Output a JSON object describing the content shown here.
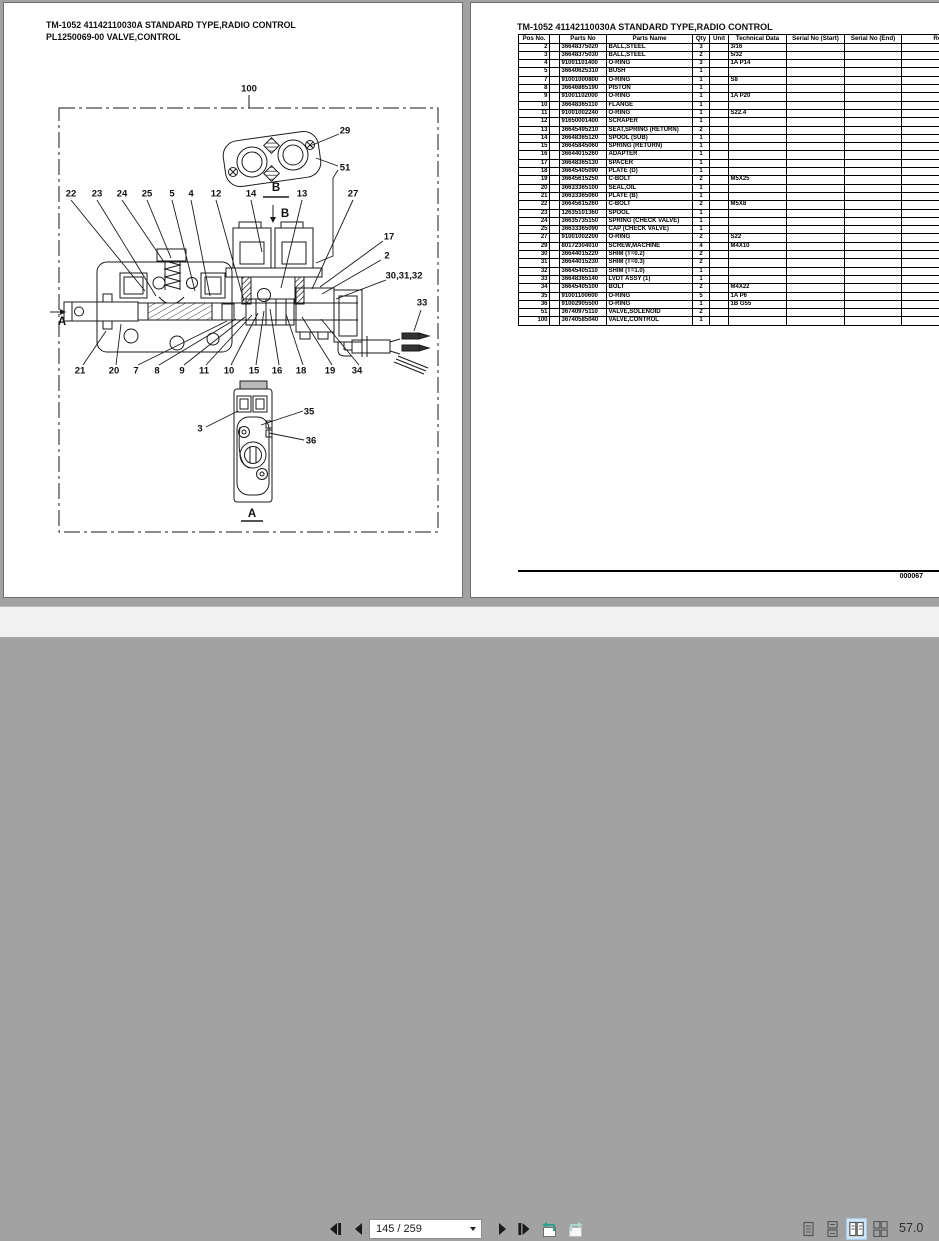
{
  "viewer": {
    "colors": {
      "canvas": "#a2a2a2",
      "toolbar_bg": "#f1f1f1",
      "active_view_bg": "#cfe3f6",
      "view_history_arrow": "#2fa08e"
    },
    "toolbar": {
      "page_indicator": "145 / 259",
      "zoom_level": "57.0",
      "active_view_mode": "facing-pages"
    }
  },
  "left_page": {
    "title_line1": "TM-1052 41142110030A STANDARD TYPE,RADIO CONTROL",
    "title_line2": "PL1250069-00 VALVE,CONTROL",
    "diagram": {
      "callouts": [
        {
          "label": "100",
          "x": 249,
          "y": 89
        },
        {
          "label": "29",
          "x": 345,
          "y": 131
        },
        {
          "label": "51",
          "x": 345,
          "y": 168
        },
        {
          "label": "B",
          "x": 276,
          "y": 188,
          "size": 11.5
        },
        {
          "label": "B",
          "x": 285,
          "y": 214,
          "size": 11.5
        },
        {
          "label": "22",
          "x": 71,
          "y": 194
        },
        {
          "label": "23",
          "x": 97,
          "y": 194
        },
        {
          "label": "24",
          "x": 122,
          "y": 194
        },
        {
          "label": "25",
          "x": 147,
          "y": 194
        },
        {
          "label": "5",
          "x": 172,
          "y": 194
        },
        {
          "label": "4",
          "x": 191,
          "y": 194
        },
        {
          "label": "12",
          "x": 216,
          "y": 194
        },
        {
          "label": "14",
          "x": 251,
          "y": 194
        },
        {
          "label": "13",
          "x": 302,
          "y": 194
        },
        {
          "label": "27",
          "x": 353,
          "y": 194
        },
        {
          "label": "17",
          "x": 389,
          "y": 237
        },
        {
          "label": "2",
          "x": 387,
          "y": 256
        },
        {
          "label": "30,31,32",
          "x": 404,
          "y": 276
        },
        {
          "label": "33",
          "x": 422,
          "y": 303
        },
        {
          "label": "A",
          "x": 62,
          "y": 322,
          "size": 11.5
        },
        {
          "label": "21",
          "x": 80,
          "y": 371
        },
        {
          "label": "20",
          "x": 114,
          "y": 371
        },
        {
          "label": "7",
          "x": 136,
          "y": 371
        },
        {
          "label": "8",
          "x": 157,
          "y": 371
        },
        {
          "label": "9",
          "x": 182,
          "y": 371
        },
        {
          "label": "11",
          "x": 204,
          "y": 371
        },
        {
          "label": "10",
          "x": 229,
          "y": 371
        },
        {
          "label": "15",
          "x": 254,
          "y": 371
        },
        {
          "label": "16",
          "x": 277,
          "y": 371
        },
        {
          "label": "18",
          "x": 301,
          "y": 371
        },
        {
          "label": "19",
          "x": 330,
          "y": 371
        },
        {
          "label": "34",
          "x": 357,
          "y": 371
        },
        {
          "label": "3",
          "x": 200,
          "y": 429
        },
        {
          "label": "35",
          "x": 309,
          "y": 412
        },
        {
          "label": "36",
          "x": 311,
          "y": 441
        },
        {
          "label": "A",
          "x": 252,
          "y": 514,
          "size": 11.5
        }
      ]
    }
  },
  "right_page": {
    "title": "TM-1052 41142110030A STANDARD TYPE,RADIO CONTROL",
    "page_number": "000067",
    "parts_table": {
      "headers": [
        "Pos No.",
        "",
        "Parts No",
        "Parts Name",
        "Qty",
        "Unit",
        "Technical Data",
        "Serial No (Start)",
        "Serial No (End)",
        "Remarks"
      ],
      "rows": [
        [
          "2",
          "36648375020",
          "BALL,STEEL",
          "3",
          "",
          "3/16",
          "",
          "",
          ""
        ],
        [
          "3",
          "36648375030",
          "BALL,STEEL",
          "2",
          "",
          "5/32",
          "",
          "",
          ""
        ],
        [
          "4",
          "91001101400",
          "O-RING",
          "3",
          "",
          "1A P14",
          "",
          "",
          ""
        ],
        [
          "5",
          "36640625310",
          "BUSH",
          "1",
          "",
          "",
          "",
          "",
          ""
        ],
        [
          "7",
          "91001000800",
          "O-RING",
          "1",
          "",
          "S8",
          "",
          "",
          ""
        ],
        [
          "8",
          "36646865190",
          "PISTON",
          "1",
          "",
          "",
          "",
          "",
          ""
        ],
        [
          "9",
          "91001102000",
          "O-RING",
          "1",
          "",
          "1A P20",
          "",
          "",
          ""
        ],
        [
          "10",
          "36648365110",
          "FLANGE",
          "1",
          "",
          "",
          "",
          "",
          ""
        ],
        [
          "11",
          "91001002240",
          "O-RING",
          "1",
          "",
          "S22.4",
          "",
          "",
          ""
        ],
        [
          "12",
          "91650001400",
          "SCRAPER",
          "1",
          "",
          "",
          "",
          "",
          ""
        ],
        [
          "13",
          "36645495210",
          "SEAT,SPRING (RETURN)",
          "2",
          "",
          "",
          "",
          "",
          ""
        ],
        [
          "14",
          "36648365120",
          "SPOOL (SUB)",
          "1",
          "",
          "",
          "",
          "",
          ""
        ],
        [
          "15",
          "36645845060",
          "SPRING (RETURN)",
          "1",
          "",
          "",
          "",
          "",
          ""
        ],
        [
          "16",
          "36644015260",
          "ADAPTER",
          "1",
          "",
          "",
          "",
          "",
          ""
        ],
        [
          "17",
          "36648365130",
          "SPACER",
          "1",
          "",
          "",
          "",
          "",
          ""
        ],
        [
          "18",
          "36645405090",
          "PLATE (D)",
          "1",
          "",
          "",
          "",
          "",
          ""
        ],
        [
          "19",
          "36645615250",
          "C-BOLT",
          "2",
          "",
          "M5X25",
          "",
          "",
          ""
        ],
        [
          "20",
          "36633365100",
          "SEAL,OIL",
          "1",
          "",
          "",
          "",
          "",
          ""
        ],
        [
          "21",
          "36633365060",
          "PLATE (B)",
          "1",
          "",
          "",
          "",
          "",
          ""
        ],
        [
          "22",
          "36645615260",
          "C-BOLT",
          "2",
          "",
          "M5X8",
          "",
          "",
          ""
        ],
        [
          "23",
          "12635101360",
          "SPOOL",
          "1",
          "",
          "",
          "",
          "",
          ""
        ],
        [
          "24",
          "36635735150",
          "SPRING (CHECK VALVE)",
          "1",
          "",
          "",
          "",
          "",
          ""
        ],
        [
          "25",
          "36633365090",
          "CAP (CHECK VALVE)",
          "1",
          "",
          "",
          "",
          "",
          ""
        ],
        [
          "27",
          "91001002200",
          "O-RING",
          "2",
          "",
          "S22",
          "",
          "",
          ""
        ],
        [
          "29",
          "80172304010",
          "SCREW,MACHINE",
          "4",
          "",
          "M4X10",
          "",
          "",
          ""
        ],
        [
          "30",
          "36644015220",
          "SHIM (T=0.2)",
          "2",
          "",
          "",
          "",
          "",
          ""
        ],
        [
          "31",
          "36644015230",
          "SHIM (T=0.3)",
          "2",
          "",
          "",
          "",
          "",
          ""
        ],
        [
          "32",
          "36645405110",
          "SHIM (T=1.0)",
          "1",
          "",
          "",
          "",
          "",
          ""
        ],
        [
          "33",
          "36648365140",
          "LVDT ASSY (1)",
          "1",
          "",
          "",
          "",
          "",
          ""
        ],
        [
          "34",
          "36645405100",
          "BOLT",
          "2",
          "",
          "M4X22",
          "",
          "",
          ""
        ],
        [
          "35",
          "91001100600",
          "O-RING",
          "5",
          "",
          "1A P6",
          "",
          "",
          ""
        ],
        [
          "36",
          "91002905500",
          "O-RING",
          "1",
          "",
          "1B G55",
          "",
          "",
          ""
        ],
        [
          "51",
          "36740975110",
          "VALVE,SOLENOID",
          "2",
          "",
          "",
          "",
          "",
          ""
        ],
        [
          "100",
          "36740585040",
          "VALVE,CONTROL",
          "1",
          "",
          "",
          "",
          "",
          ""
        ]
      ]
    }
  }
}
